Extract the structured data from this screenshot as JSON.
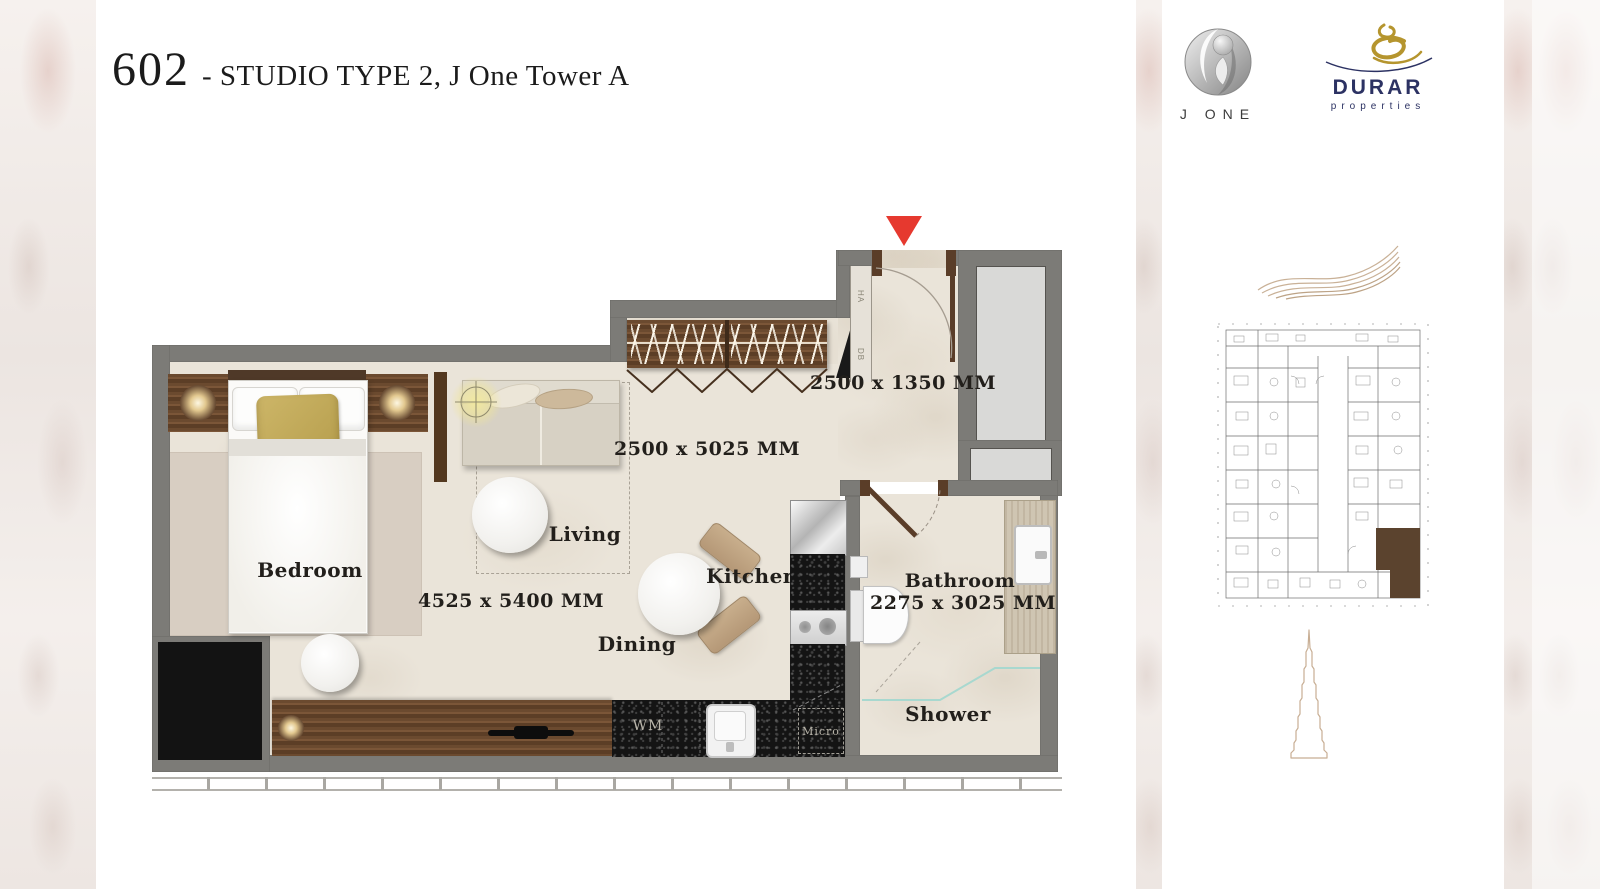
{
  "header": {
    "unit_number": "602",
    "title": "- STUDIO TYPE 2, J One Tower A"
  },
  "branding": {
    "jone": {
      "name": "J ONE"
    },
    "durar": {
      "name": "DURAR",
      "tagline": "properties"
    }
  },
  "plan": {
    "labels": {
      "bedroom": "Bedroom",
      "living": "Living",
      "dining": "Dining",
      "kitchen": "Kitchen",
      "bathroom": "Bathroom",
      "shower": "Shower"
    },
    "dimensions": {
      "entry": "2500 x 1350 MM",
      "living": "2500 x 5025 MM",
      "bedroom_area": "4525 x 5400 MM",
      "bathroom": "2275 x 3025 MM"
    },
    "appliances": {
      "washing_machine": "WM",
      "microwave": "Micro"
    },
    "utility_labels": {
      "ha": "HA",
      "db": "DB"
    }
  },
  "colors": {
    "wall_gray": "#7c7b77",
    "floor_beige": "#eae4d9",
    "wood_brown": "#6b4a2f",
    "counter_black": "#141414",
    "rug_beige": "#d8cec2",
    "accent_red": "#e6392f",
    "gold_pillow": "#c3ab5c",
    "durar_navy": "#2c3263",
    "ornament_tan": "#c8ae94"
  }
}
